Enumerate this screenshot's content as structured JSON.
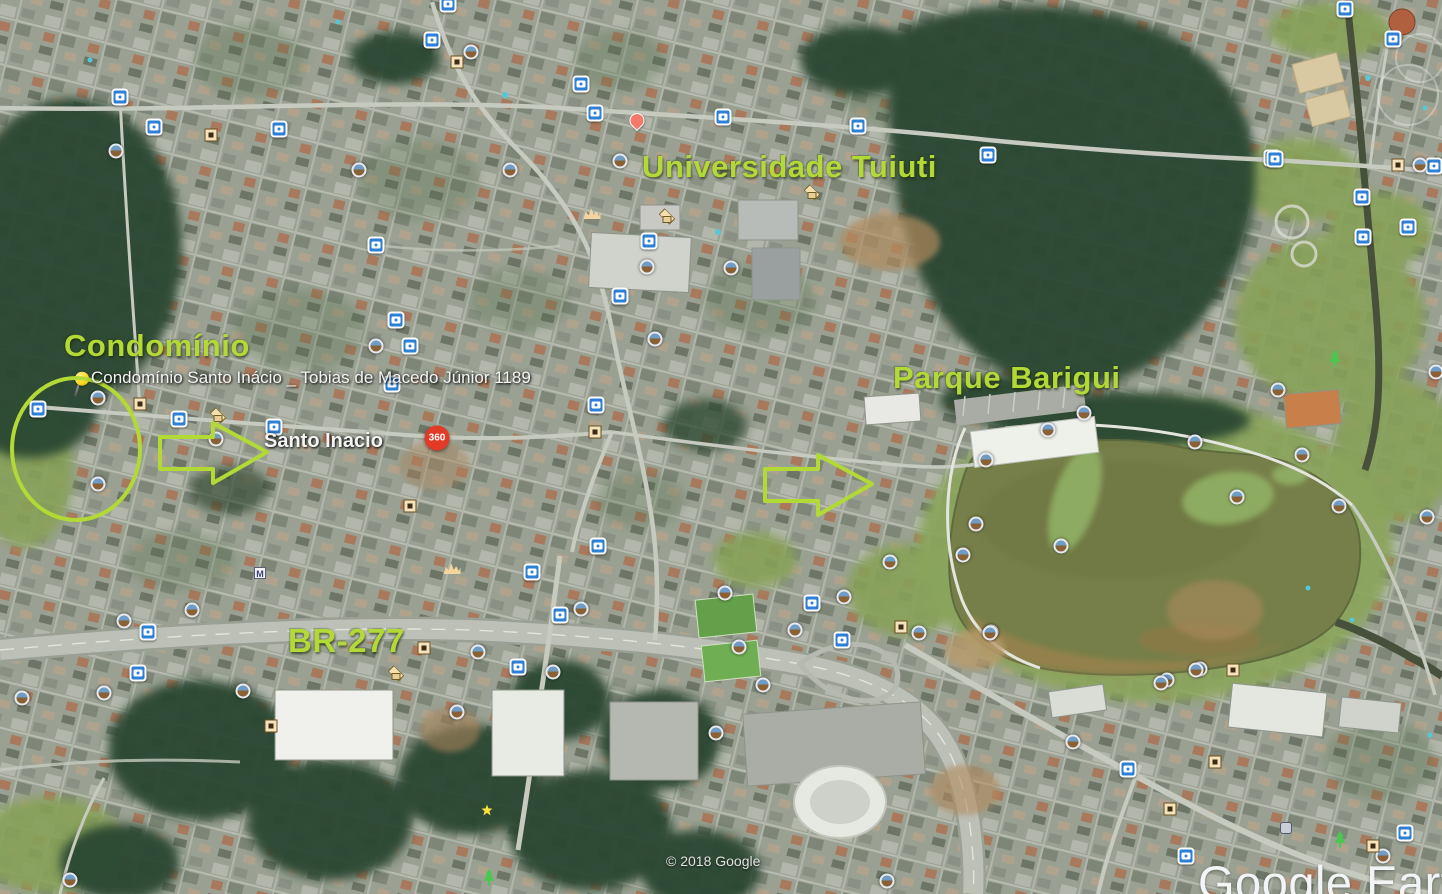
{
  "app": {
    "name": "Google Earth",
    "logo_text": "Google Earth",
    "copyright": "© 2018 Google"
  },
  "colors": {
    "annotation_green": "#b2d936",
    "label_white": "#f4f4f4",
    "camera_marker_blue": "#2e7fd6",
    "poi_360_red": "#e33a28",
    "pushpin_yellow": "#ffd921"
  },
  "labels": {
    "condominio": {
      "text": "Condomínio"
    },
    "universidade": {
      "text": "Universidade Tuiuti"
    },
    "parque": {
      "text": "Parque Barigui"
    },
    "br277": {
      "text": "BR-277"
    },
    "pin_address": {
      "text": "Condomínio Santo Inácio _  Tobias de Macedo Júnior 1189"
    },
    "santo_inacio": {
      "text": "Santo Inacio"
    }
  },
  "annotations": {
    "circle": {
      "cx": 76,
      "cy": 449,
      "rx": 64,
      "ry": 71
    },
    "arrows": [
      {
        "name": "arrow-to-santo-inacio",
        "points": "160,437 213,437 213,423 267,452 213,483 213,469 160,469"
      },
      {
        "name": "arrow-to-parque",
        "points": "765,469 818,469 818,455 872,484 818,515 818,501 765,501"
      }
    ]
  },
  "markers": [
    {
      "type": "camera",
      "x": 432,
      "y": 40
    },
    {
      "type": "camera",
      "x": 581,
      "y": 84
    },
    {
      "type": "camera",
      "x": 723,
      "y": 117
    },
    {
      "type": "camera",
      "x": 858,
      "y": 126
    },
    {
      "type": "camera",
      "x": 988,
      "y": 155
    },
    {
      "type": "camera",
      "x": 1272,
      "y": 158
    },
    {
      "type": "camera",
      "x": 120,
      "y": 97
    },
    {
      "type": "camera",
      "x": 154,
      "y": 127
    },
    {
      "type": "camera",
      "x": 279,
      "y": 129
    },
    {
      "type": "camera",
      "x": 595,
      "y": 113
    },
    {
      "type": "camera",
      "x": 448,
      "y": 4
    },
    {
      "type": "camera",
      "x": 376,
      "y": 245
    },
    {
      "type": "camera",
      "x": 649,
      "y": 241
    },
    {
      "type": "camera",
      "x": 396,
      "y": 320
    },
    {
      "type": "camera",
      "x": 410,
      "y": 346
    },
    {
      "type": "camera",
      "x": 620,
      "y": 296
    },
    {
      "type": "camera",
      "x": 38,
      "y": 409
    },
    {
      "type": "camera",
      "x": 179,
      "y": 419
    },
    {
      "type": "camera",
      "x": 274,
      "y": 427
    },
    {
      "type": "camera",
      "x": 392,
      "y": 384
    },
    {
      "type": "camera",
      "x": 596,
      "y": 405
    },
    {
      "type": "camera",
      "x": 598,
      "y": 546
    },
    {
      "type": "camera",
      "x": 532,
      "y": 572
    },
    {
      "type": "camera",
      "x": 560,
      "y": 615
    },
    {
      "type": "camera",
      "x": 518,
      "y": 667
    },
    {
      "type": "camera",
      "x": 138,
      "y": 673
    },
    {
      "type": "camera",
      "x": 148,
      "y": 632
    },
    {
      "type": "camera",
      "x": 812,
      "y": 603
    },
    {
      "type": "camera",
      "x": 842,
      "y": 640
    },
    {
      "type": "camera",
      "x": 1128,
      "y": 769
    },
    {
      "type": "camera",
      "x": 1186,
      "y": 856
    },
    {
      "type": "camera",
      "x": 1405,
      "y": 833
    },
    {
      "type": "camera",
      "x": 1345,
      "y": 9
    },
    {
      "type": "camera",
      "x": 1393,
      "y": 39
    },
    {
      "type": "camera",
      "x": 1275,
      "y": 159
    },
    {
      "type": "camera",
      "x": 1362,
      "y": 197
    },
    {
      "type": "camera",
      "x": 1363,
      "y": 237
    },
    {
      "type": "camera",
      "x": 1408,
      "y": 227
    },
    {
      "type": "camera",
      "x": 1434,
      "y": 166
    },
    {
      "type": "panoramio",
      "x": 471,
      "y": 52
    },
    {
      "type": "panoramio",
      "x": 116,
      "y": 151
    },
    {
      "type": "panoramio",
      "x": 359,
      "y": 170
    },
    {
      "type": "panoramio",
      "x": 510,
      "y": 170
    },
    {
      "type": "panoramio",
      "x": 620,
      "y": 161
    },
    {
      "type": "panoramio",
      "x": 647,
      "y": 267
    },
    {
      "type": "panoramio",
      "x": 731,
      "y": 268
    },
    {
      "type": "panoramio",
      "x": 655,
      "y": 339
    },
    {
      "type": "panoramio",
      "x": 376,
      "y": 346
    },
    {
      "type": "panoramio",
      "x": 98,
      "y": 398
    },
    {
      "type": "panoramio",
      "x": 98,
      "y": 484
    },
    {
      "type": "panoramio",
      "x": 216,
      "y": 439
    },
    {
      "type": "panoramio",
      "x": 124,
      "y": 621
    },
    {
      "type": "panoramio",
      "x": 192,
      "y": 610
    },
    {
      "type": "panoramio",
      "x": 22,
      "y": 698
    },
    {
      "type": "panoramio",
      "x": 104,
      "y": 693
    },
    {
      "type": "panoramio",
      "x": 243,
      "y": 691
    },
    {
      "type": "panoramio",
      "x": 478,
      "y": 652
    },
    {
      "type": "panoramio",
      "x": 553,
      "y": 672
    },
    {
      "type": "panoramio",
      "x": 581,
      "y": 609
    },
    {
      "type": "panoramio",
      "x": 457,
      "y": 712
    },
    {
      "type": "panoramio",
      "x": 70,
      "y": 880
    },
    {
      "type": "panoramio",
      "x": 725,
      "y": 593
    },
    {
      "type": "panoramio",
      "x": 844,
      "y": 597
    },
    {
      "type": "panoramio",
      "x": 890,
      "y": 562
    },
    {
      "type": "panoramio",
      "x": 795,
      "y": 630
    },
    {
      "type": "panoramio",
      "x": 739,
      "y": 647
    },
    {
      "type": "panoramio",
      "x": 919,
      "y": 633
    },
    {
      "type": "panoramio",
      "x": 991,
      "y": 632
    },
    {
      "type": "panoramio",
      "x": 763,
      "y": 685
    },
    {
      "type": "panoramio",
      "x": 1167,
      "y": 680
    },
    {
      "type": "panoramio",
      "x": 1200,
      "y": 669
    },
    {
      "type": "panoramio",
      "x": 1073,
      "y": 742
    },
    {
      "type": "panoramio",
      "x": 887,
      "y": 881
    },
    {
      "type": "panoramio",
      "x": 1383,
      "y": 856
    },
    {
      "type": "panoramio",
      "x": 1278,
      "y": 390
    },
    {
      "type": "panoramio",
      "x": 1084,
      "y": 413
    },
    {
      "type": "panoramio",
      "x": 1048,
      "y": 430
    },
    {
      "type": "panoramio",
      "x": 1195,
      "y": 442
    },
    {
      "type": "panoramio",
      "x": 986,
      "y": 460
    },
    {
      "type": "panoramio",
      "x": 1302,
      "y": 455
    },
    {
      "type": "panoramio",
      "x": 1237,
      "y": 497
    },
    {
      "type": "panoramio",
      "x": 1339,
      "y": 506
    },
    {
      "type": "panoramio",
      "x": 976,
      "y": 524
    },
    {
      "type": "panoramio",
      "x": 1061,
      "y": 546
    },
    {
      "type": "panoramio",
      "x": 963,
      "y": 555
    },
    {
      "type": "panoramio",
      "x": 1427,
      "y": 517
    },
    {
      "type": "panoramio",
      "x": 990,
      "y": 633
    },
    {
      "type": "panoramio",
      "x": 1196,
      "y": 670
    },
    {
      "type": "panoramio",
      "x": 1161,
      "y": 683
    },
    {
      "type": "panoramio",
      "x": 1420,
      "y": 165
    },
    {
      "type": "panoramio",
      "x": 716,
      "y": 733
    },
    {
      "type": "panoramio",
      "x": 1436,
      "y": 372
    },
    {
      "type": "photo-frame",
      "x": 457,
      "y": 62
    },
    {
      "type": "photo-frame",
      "x": 211,
      "y": 135
    },
    {
      "type": "photo-frame",
      "x": 140,
      "y": 404
    },
    {
      "type": "photo-frame",
      "x": 595,
      "y": 432
    },
    {
      "type": "photo-frame",
      "x": 410,
      "y": 506
    },
    {
      "type": "photo-frame",
      "x": 424,
      "y": 648
    },
    {
      "type": "photo-frame",
      "x": 271,
      "y": 726
    },
    {
      "type": "photo-frame",
      "x": 901,
      "y": 627
    },
    {
      "type": "photo-frame",
      "x": 1233,
      "y": 670
    },
    {
      "type": "photo-frame",
      "x": 1215,
      "y": 762
    },
    {
      "type": "photo-frame",
      "x": 1170,
      "y": 809
    },
    {
      "type": "photo-frame",
      "x": 1373,
      "y": 846
    },
    {
      "type": "photo-frame",
      "x": 1398,
      "y": 165
    },
    {
      "type": "school",
      "x": 666,
      "y": 216
    },
    {
      "type": "school",
      "x": 811,
      "y": 192
    },
    {
      "type": "school",
      "x": 217,
      "y": 415
    },
    {
      "type": "school",
      "x": 395,
      "y": 673
    },
    {
      "type": "people",
      "x": 592,
      "y": 213
    },
    {
      "type": "people",
      "x": 452,
      "y": 568
    },
    {
      "type": "tree",
      "x": 1335,
      "y": 358
    },
    {
      "type": "tree",
      "x": 1340,
      "y": 839
    },
    {
      "type": "tree",
      "x": 489,
      "y": 877
    },
    {
      "type": "red-pin",
      "x": 637,
      "y": 128
    },
    {
      "type": "pushpin",
      "x": 76,
      "y": 396
    },
    {
      "type": "photo-360",
      "x": 437,
      "y": 438,
      "label": "360"
    },
    {
      "type": "star",
      "x": 487,
      "y": 810
    },
    {
      "type": "misc",
      "x": 1286,
      "y": 828
    },
    {
      "type": "metro",
      "x": 260,
      "y": 573,
      "label": "M"
    }
  ]
}
